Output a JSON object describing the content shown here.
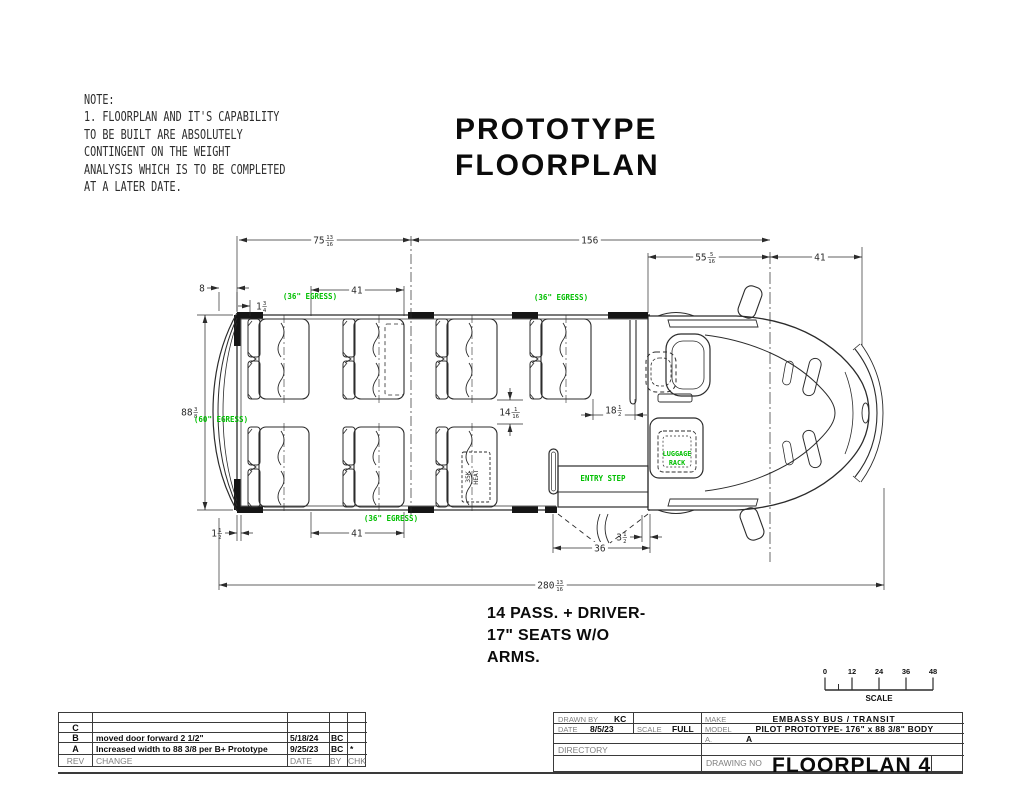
{
  "note": {
    "lines": [
      "NOTE:",
      "1.  FLOORPLAN AND IT'S CAPABILITY",
      "TO BE BUILT ARE ABSOLUTELY",
      "CONTINGENT ON THE WEIGHT",
      "ANALYSIS WHICH IS TO BE COMPLETED",
      "AT A LATER DATE."
    ]
  },
  "title": {
    "lines": [
      "PROTOTYPE",
      "FLOORPLAN"
    ]
  },
  "caption": {
    "lines": [
      "14 PASS. + DRIVER-",
      "17\" SEATS W/O",
      "ARMS."
    ]
  },
  "dimensions": {
    "rear_section": "75 13/16",
    "mid_section": "156",
    "cab_section": "55 5/16",
    "front_overhang": "41",
    "rear_offset": "8",
    "seat_offset": "1 3/4",
    "seat_pitch_top": "41",
    "body_width": "88 3/8",
    "aisle_width": "14 1/16",
    "driver_gap": "18 1/2",
    "rear_gap": "1 1/2",
    "seat_pitch_bottom": "41",
    "door_width": "36",
    "door_offset": "3 1/2",
    "overall_length": "280 13/16"
  },
  "labels": {
    "egress_36": "(36\" EGRESS)",
    "egress_60": "(60\" EGRESS)",
    "entry_step": "ENTRY STEP",
    "luggage_rack_line1": "LUGGAGE",
    "luggage_rack_line2": "RACK",
    "heater_line1": "35K",
    "heater_line2": "HEAT"
  },
  "scale_bar": {
    "ticks": [
      "0",
      "12",
      "24",
      "36",
      "48"
    ],
    "label": "SCALE"
  },
  "title_block": {
    "drawn_by_label": "DRAWN BY",
    "drawn_by": "KC",
    "date_label": "DATE",
    "date": "8/5/23",
    "scale_label": "SCALE",
    "scale": "FULL",
    "make_label": "MAKE",
    "make": "EMBASSY BUS / TRANSIT",
    "model_label": "MODEL",
    "model": "PILOT PROTOTYPE- 176\" x 88 3/8\" BODY",
    "rev_label": "A.",
    "rev": "A",
    "directory_label": "DIRECTORY",
    "drawing_no_label": "DRAWING NO",
    "drawing_no": "FLOORPLAN 4"
  },
  "revision_table": {
    "headers": {
      "rev": "REV",
      "change": "CHANGE",
      "date": "DATE",
      "by": "BY",
      "chk": "CHK"
    },
    "rows": [
      {
        "rev": "C",
        "change": "",
        "date": "",
        "by": "",
        "chk": ""
      },
      {
        "rev": "B",
        "change": "moved door forward 2 1/2\"",
        "date": "5/18/24",
        "by": "BC",
        "chk": ""
      },
      {
        "rev": "A",
        "change": "Increased width to 88 3/8 per B+ Prototype",
        "date": "9/25/23",
        "by": "BC",
        "chk": "*"
      }
    ]
  },
  "colors": {
    "egress_green": "#00bf00",
    "line": "#2b2b2b"
  }
}
